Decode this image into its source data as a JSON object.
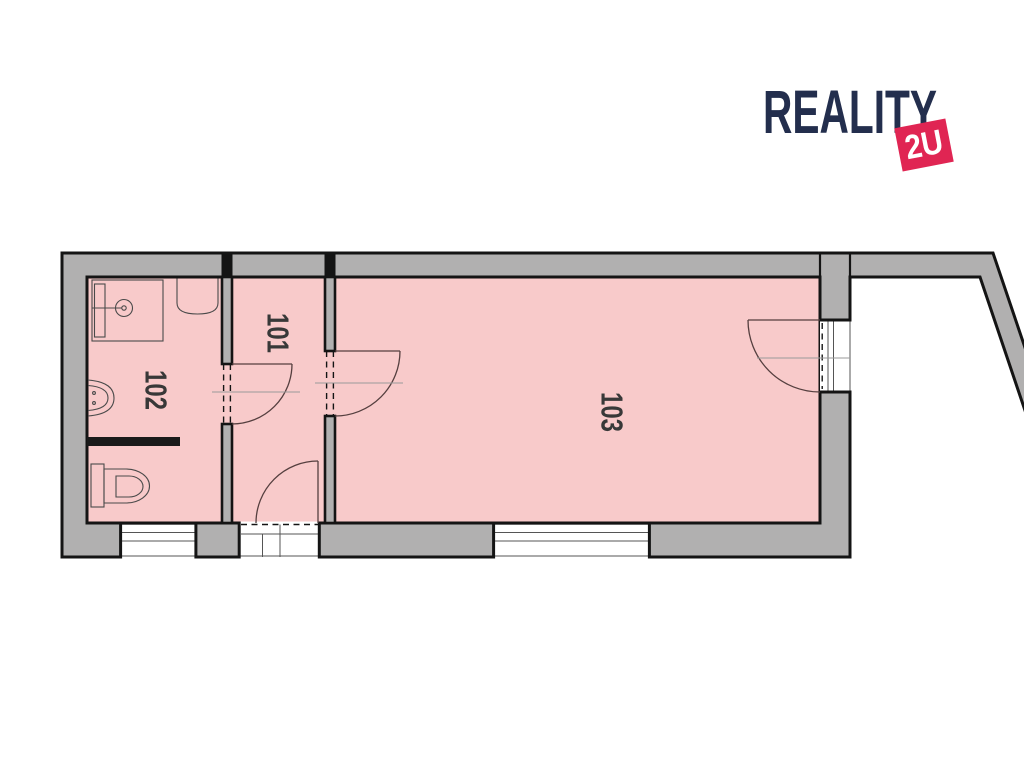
{
  "page": {
    "background": "#ffffff"
  },
  "logo": {
    "brand_text": "REALITY",
    "badge_text": "2U",
    "brand_color": "#232e4d",
    "badge_color": "#e02553",
    "badge_text_color": "#ffffff"
  },
  "floorplan": {
    "floor_color": "#f8caca",
    "wall_fill": "#b1b0b0",
    "outline_color": "#141414",
    "label_color": "#383838",
    "rooms": [
      {
        "number": "101"
      },
      {
        "number": "102"
      },
      {
        "number": "103"
      }
    ],
    "fixtures": [
      "shower",
      "washbasin",
      "sink",
      "toilet"
    ],
    "doors": [
      "door-102-to-101",
      "door-101-to-103",
      "entrance-door-south",
      "exterior-door-east"
    ],
    "windows": [
      "window-south-left",
      "window-south-right"
    ]
  }
}
